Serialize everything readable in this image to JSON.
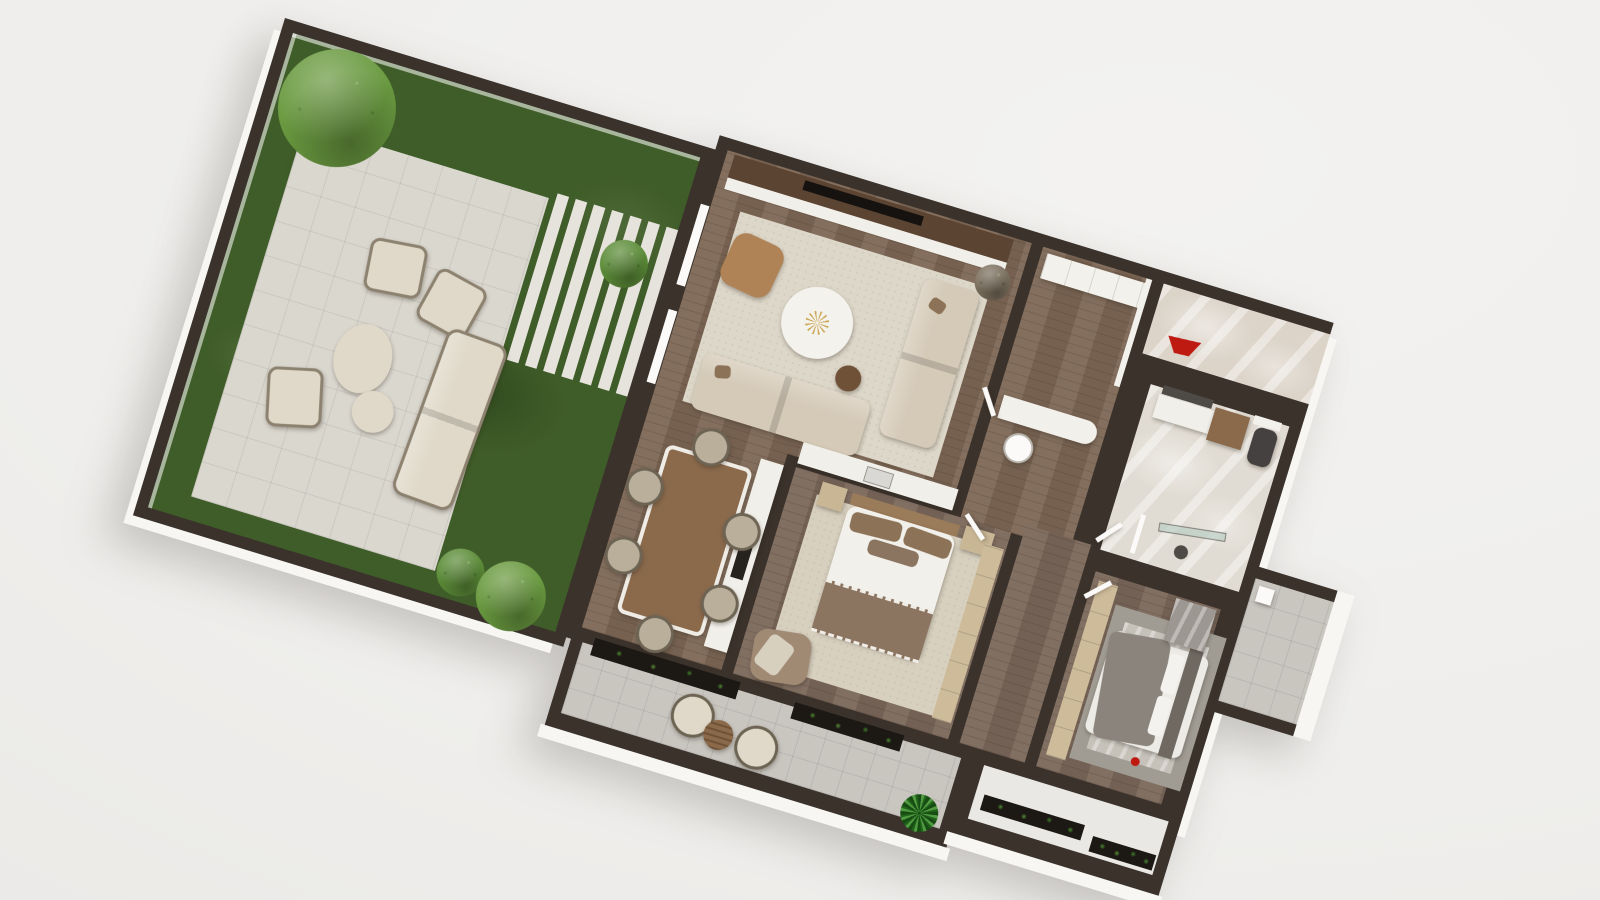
{
  "scene": {
    "label": "3d-apartment-floor-plan-render",
    "view": "top-down axonometric, plan rotated ~17 degrees clockwise",
    "rooms": [
      {
        "id": "garden",
        "contains": [
          "grass lawn",
          "paved patio",
          "stepping-stone path",
          "large tree",
          "three bushes",
          "outdoor sofa",
          "three outdoor armchairs",
          "two oval poufs"
        ]
      },
      {
        "id": "living-room",
        "contains": [
          "tv console",
          "television",
          "area rug",
          "two beige sofas",
          "tan leather armchair",
          "round white coffee table",
          "gold starburst decor",
          "round walnut side table",
          "dry plant"
        ]
      },
      {
        "id": "dining-area",
        "contains": [
          "rectangular wood dining table",
          "six wicker chairs"
        ]
      },
      {
        "id": "kitchen",
        "contains": [
          "L-shaped white counter",
          "dark cooktop",
          "sink"
        ]
      },
      {
        "id": "entry-hall",
        "contains": [
          "white closet row",
          "white desk",
          "desk chair"
        ]
      },
      {
        "id": "bathroom",
        "contains": [
          "vanity with sink",
          "wood cabinet",
          "mirror",
          "wall cabinet",
          "dark toilet",
          "glass shower screen",
          "floor drain"
        ]
      },
      {
        "id": "master-bedroom",
        "contains": [
          "double bed",
          "wood headboard",
          "brown pillows",
          "white duvet",
          "striped taupe blanket",
          "two nightstands",
          "wardrobe strip",
          "cream rug",
          "taupe armchair"
        ]
      },
      {
        "id": "bedroom-2",
        "contains": [
          "double bed",
          "gray headboard",
          "white pillows",
          "gray draped blanket",
          "closet bench",
          "gray bordered rug",
          "gray marble dresser",
          "red decor"
        ]
      },
      {
        "id": "terrace",
        "contains": [
          "marble tiles",
          "red bowl"
        ]
      },
      {
        "id": "balcony-main",
        "contains": [
          "two wicker chairs",
          "round slatted wood table",
          "potted plant",
          "two dark planter boxes"
        ]
      },
      {
        "id": "balcony-bedroom",
        "contains": [
          "two dark planter boxes"
        ]
      },
      {
        "id": "side-terrace",
        "contains": [
          "gray tiles",
          "white box"
        ]
      }
    ]
  },
  "palette": {
    "wall": "#3a322b",
    "rim": "#f7f6f3",
    "grass": "#3f5d28",
    "patio": "#dad7cf",
    "stone": "#e6e3dc",
    "treeGreen": "#6a9a40",
    "bushGreen": "#5c8c38",
    "woodFloor": "#7d6755",
    "woodBedroom": "#7a675a",
    "consoleWood": "#5c4433",
    "tvBlack": "#15120f",
    "rugLiving": "#ddd7c9",
    "rugMaster": "#d8d0bf",
    "rug2Border": "#a09c94",
    "rug2Inner": "#c6c2ba",
    "sofaBeige": "#d5cab8",
    "outdoorCushion": "#e0d9c9",
    "pillowBrown": "#8c7257",
    "armchairTan": "#b08356",
    "coffeeWhite": "#f4f2ed",
    "gold": "#c9a24b",
    "sideTableBrown": "#6f5138",
    "twigPlant": "#7b6f5e",
    "tableWood": "#8b6a4c",
    "wicker": "#b9af9b",
    "counterWhite": "#f1efe9",
    "cooktopDark": "#26231f",
    "sinkSteel": "#d9d8d4",
    "closetWhite": "#f3f1ec",
    "lightWood": "#cdbb9a",
    "nightstand": "#c8b695",
    "duvetWhite": "#f2f0ea",
    "blanketTaupe": "#8b7460",
    "headboardWood": "#9a7b5a",
    "armchairTaupe": "#a18a74",
    "duvet2": "#edebe6",
    "blanket2": "#8a847c",
    "headboard2": "#6f6962",
    "pillowWhite": "#f4f2ee",
    "marbleTerrace": "#dcd4c9",
    "bathFloor": "#e1dcd3",
    "marbleGray": "#9c9791",
    "toilet": "#454140",
    "mirror": "#4e4a46",
    "glassTeal": "#b7cdc4",
    "balconyTile": "#c9c6c0",
    "balcony2Floor": "#eae8e4",
    "planterDark": "#1c1814",
    "plantGreen": "#2e7d28",
    "accentRed": "#bf1a12",
    "deskWhite": "#f2f0eb",
    "doorWhite": "#fbfaf8"
  }
}
